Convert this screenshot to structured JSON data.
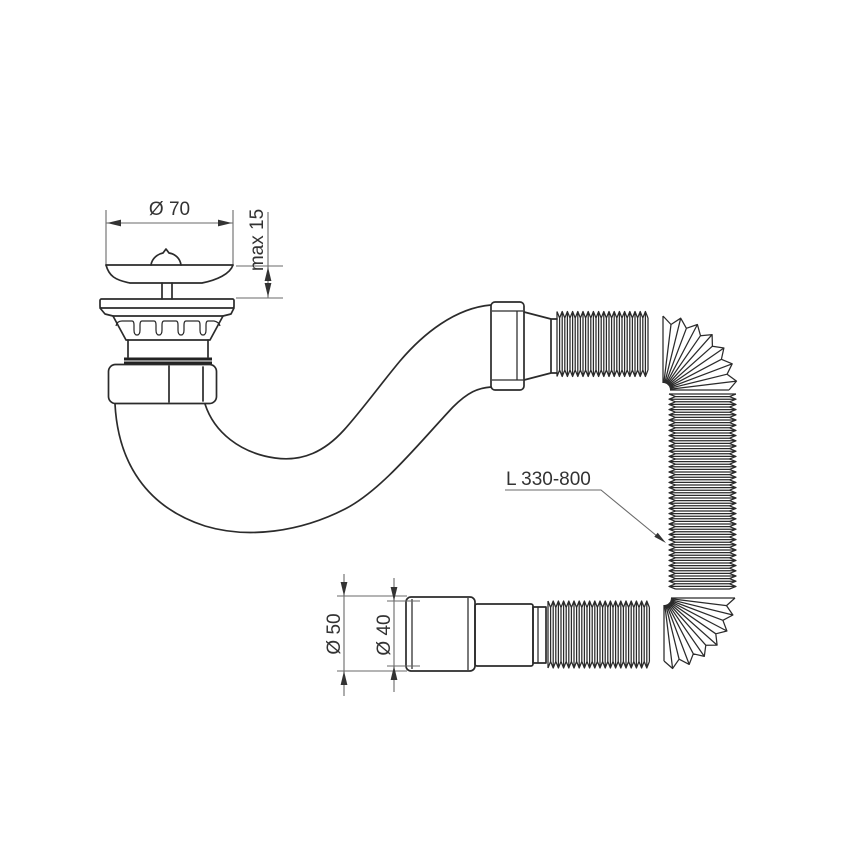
{
  "drawing": {
    "type": "technical-drawing",
    "subject": "bath drain waste kit with strainer plug, curved tailpipe and extensible corrugated hose",
    "colors": {
      "background": "#ffffff",
      "line": "#2b2b2b",
      "dimension_line": "#6a6a6a",
      "text": "#333333"
    },
    "dimensions": {
      "strainer_diameter": "Ø 70",
      "cap_height": "max 15",
      "hose_length": "L 330-800",
      "outlet_outer_diameter": "Ø 50",
      "outlet_inner_diameter": "Ø 40"
    },
    "parts": [
      "plug-cap-with-knob",
      "strainer-flange",
      "castellated-strainer-body",
      "compression-nut",
      "curved-tailpipe",
      "hex-union-fitting",
      "corrugated-flexible-hose",
      "outlet-reducer-connector"
    ]
  }
}
